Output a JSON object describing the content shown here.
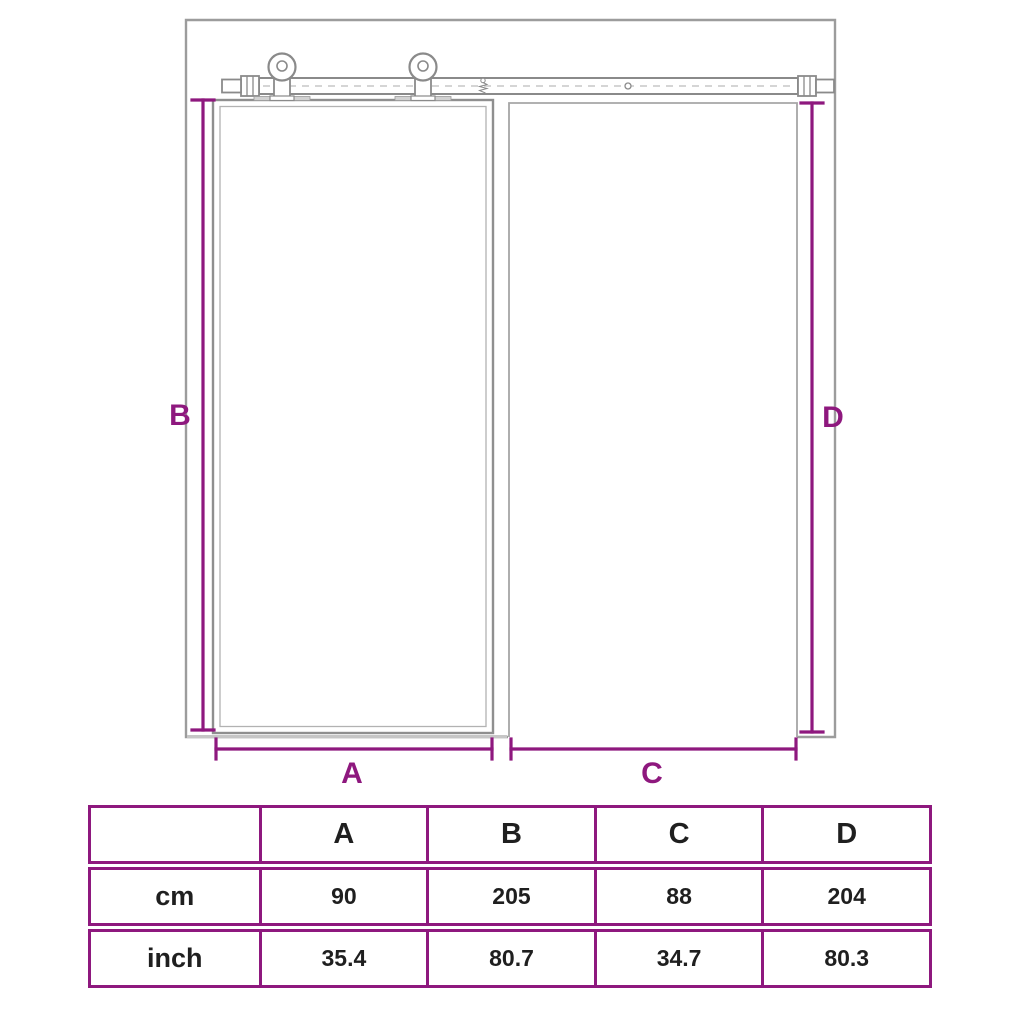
{
  "colors": {
    "accent_purple": "#8E187E",
    "drawing_line_gray": "#9B9B9B",
    "text_black": "#1F1F1F"
  },
  "diagram": {
    "labels": {
      "a": "A",
      "b": "B",
      "c": "C",
      "d": "D"
    }
  },
  "table": {
    "columns": [
      "",
      "A",
      "B",
      "C",
      "D"
    ],
    "rows": [
      {
        "label": "cm",
        "values": [
          "90",
          "205",
          "88",
          "204"
        ]
      },
      {
        "label": "inch",
        "values": [
          "35.4",
          "80.7",
          "34.7",
          "80.3"
        ]
      }
    ]
  }
}
